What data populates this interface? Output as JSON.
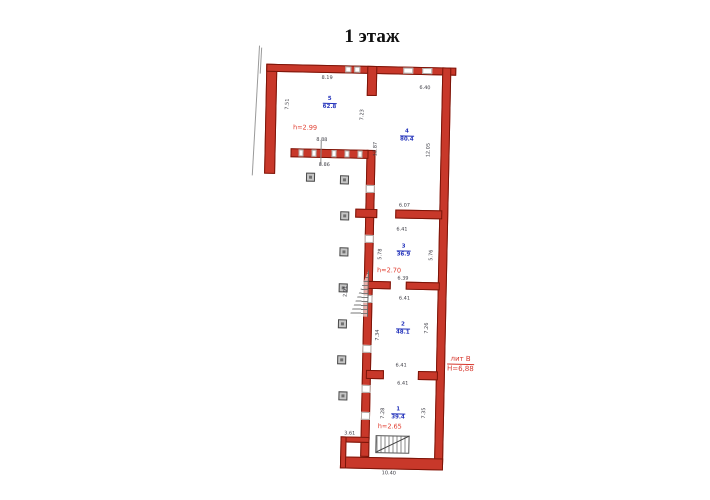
{
  "title": "1 этаж",
  "plan": {
    "rooms": [
      {
        "number": "5",
        "area": "62.8",
        "x": 80,
        "y": 50
      },
      {
        "number": "4",
        "area": "80.4",
        "x": 158,
        "y": 81
      },
      {
        "number": "3",
        "area": "36.9",
        "x": 157,
        "y": 196
      },
      {
        "number": "2",
        "area": "48.1",
        "x": 158,
        "y": 274
      },
      {
        "number": "1",
        "area": "39.4",
        "x": 155,
        "y": 359
      }
    ],
    "height_labels": [
      {
        "text": "h=2.99",
        "x": 56,
        "y": 75
      },
      {
        "text": "h=2.70",
        "x": 143,
        "y": 216
      },
      {
        "text": "h=2.65",
        "x": 147,
        "y": 372
      }
    ],
    "building_label": {
      "liter": "лит В",
      "height": "Н=6,88"
    },
    "dimensions": [
      {
        "text": "8.19",
        "x": 77,
        "y": 25,
        "vertical": false
      },
      {
        "text": "6.40",
        "x": 175,
        "y": 33,
        "vertical": false
      },
      {
        "text": "8.88",
        "x": 73,
        "y": 87,
        "vertical": false
      },
      {
        "text": "8.86",
        "x": 76,
        "y": 112,
        "vertical": false
      },
      {
        "text": "6.07",
        "x": 157,
        "y": 151,
        "vertical": false
      },
      {
        "text": "6.41",
        "x": 155,
        "y": 175,
        "vertical": false
      },
      {
        "text": "6.39",
        "x": 157,
        "y": 224,
        "vertical": false
      },
      {
        "text": "6.41",
        "x": 159,
        "y": 244,
        "vertical": false
      },
      {
        "text": "6.41",
        "x": 157,
        "y": 311,
        "vertical": false
      },
      {
        "text": "6.41",
        "x": 159,
        "y": 329,
        "vertical": false
      },
      {
        "text": "3.61",
        "x": 107,
        "y": 380,
        "vertical": false
      },
      {
        "text": "10.40",
        "x": 147,
        "y": 419,
        "vertical": false
      },
      {
        "text": "7.51",
        "x": 38,
        "y": 52,
        "vertical": true
      },
      {
        "text": "7.23",
        "x": 113,
        "y": 61,
        "vertical": true
      },
      {
        "text": "12.87",
        "x": 127,
        "y": 95,
        "vertical": true
      },
      {
        "text": "12.05",
        "x": 180,
        "y": 95,
        "vertical": true
      },
      {
        "text": "5.78",
        "x": 134,
        "y": 200,
        "vertical": true
      },
      {
        "text": "5.76",
        "x": 185,
        "y": 200,
        "vertical": true
      },
      {
        "text": "7.34",
        "x": 133,
        "y": 281,
        "vertical": true
      },
      {
        "text": "7.26",
        "x": 182,
        "y": 273,
        "vertical": true
      },
      {
        "text": "7.28",
        "x": 140,
        "y": 359,
        "vertical": true
      },
      {
        "text": "7.35",
        "x": 181,
        "y": 358,
        "vertical": true
      },
      {
        "text": "2.91",
        "x": 100,
        "y": 238,
        "vertical": true
      }
    ],
    "columns": [
      {
        "x": 58,
        "y": 120
      },
      {
        "x": 92,
        "y": 122
      },
      {
        "x": 93,
        "y": 158
      },
      {
        "x": 93,
        "y": 194
      },
      {
        "x": 93,
        "y": 230
      },
      {
        "x": 93,
        "y": 266
      },
      {
        "x": 93,
        "y": 302
      },
      {
        "x": 95,
        "y": 338
      }
    ]
  },
  "colors": {
    "wall_fill": "#c8382a",
    "wall_outline": "#7a1408",
    "room_label": "#2433bb",
    "height_label": "#e03a2c",
    "dimension_text": "#3c3c44"
  }
}
